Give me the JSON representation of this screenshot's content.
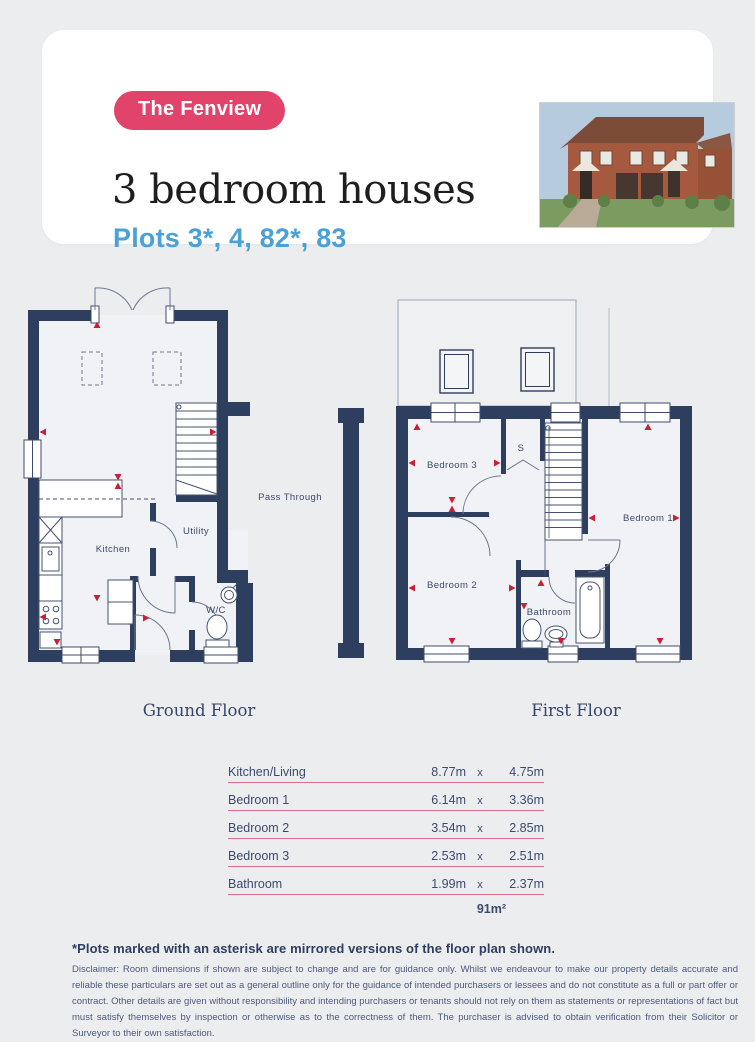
{
  "colors": {
    "page_bg": "#ecedef",
    "wall_navy": "#2e3e5e",
    "badge_pink": "#e2436a",
    "plots_blue": "#4ba1d6",
    "table_rule_pink": "#df6d85",
    "arrow_red": "#c9203a"
  },
  "header": {
    "badge": "The Fenview",
    "title": "3 bedroom houses",
    "subtitle": "Plots 3*, 4, 82*, 83",
    "photo_alt": "house-exterior-render"
  },
  "plans": {
    "ground": {
      "title": "Ground Floor",
      "labels": {
        "kitchen": "Kitchen",
        "utility": "Utility",
        "wc": "W/C",
        "pass_through": "Pass Through"
      }
    },
    "first": {
      "title": "First Floor",
      "labels": {
        "bedroom1": "Bedroom 1",
        "bedroom2": "Bedroom 2",
        "bedroom3": "Bedroom 3",
        "bathroom": "Bathroom",
        "store": "S"
      }
    }
  },
  "table": {
    "x_sep": "x",
    "rows": [
      {
        "room": "Kitchen/Living",
        "w": "8.77m",
        "h": "4.75m"
      },
      {
        "room": "Bedroom 1",
        "w": "6.14m",
        "h": "3.36m"
      },
      {
        "room": "Bedroom 2",
        "w": "3.54m",
        "h": "2.85m"
      },
      {
        "room": "Bedroom 3",
        "w": "2.53m",
        "h": "2.51m"
      },
      {
        "room": "Bathroom",
        "w": "1.99m",
        "h": "2.37m"
      }
    ],
    "total": "91m²"
  },
  "footer": {
    "note": "*Plots marked with an asterisk are mirrored versions of the floor plan shown.",
    "disclaimer": "Disclaimer: Room dimensions if shown are subject to change and are for guidance only. Whilst we endeavour to make our property details accurate and reliable these particulars are set out as a general outline only for the guidance of intended purchasers or lessees and do not constitute as a full or part offer or contract. Other details are given without responsibility and intending purchasers or tenants should not rely on them as statements or representations of fact but must satisfy themselves by inspection or otherwise as to the correctness of them. The purchaser is advised to obtain verification from their Solicitor or Surveyor to their own satisfaction."
  }
}
